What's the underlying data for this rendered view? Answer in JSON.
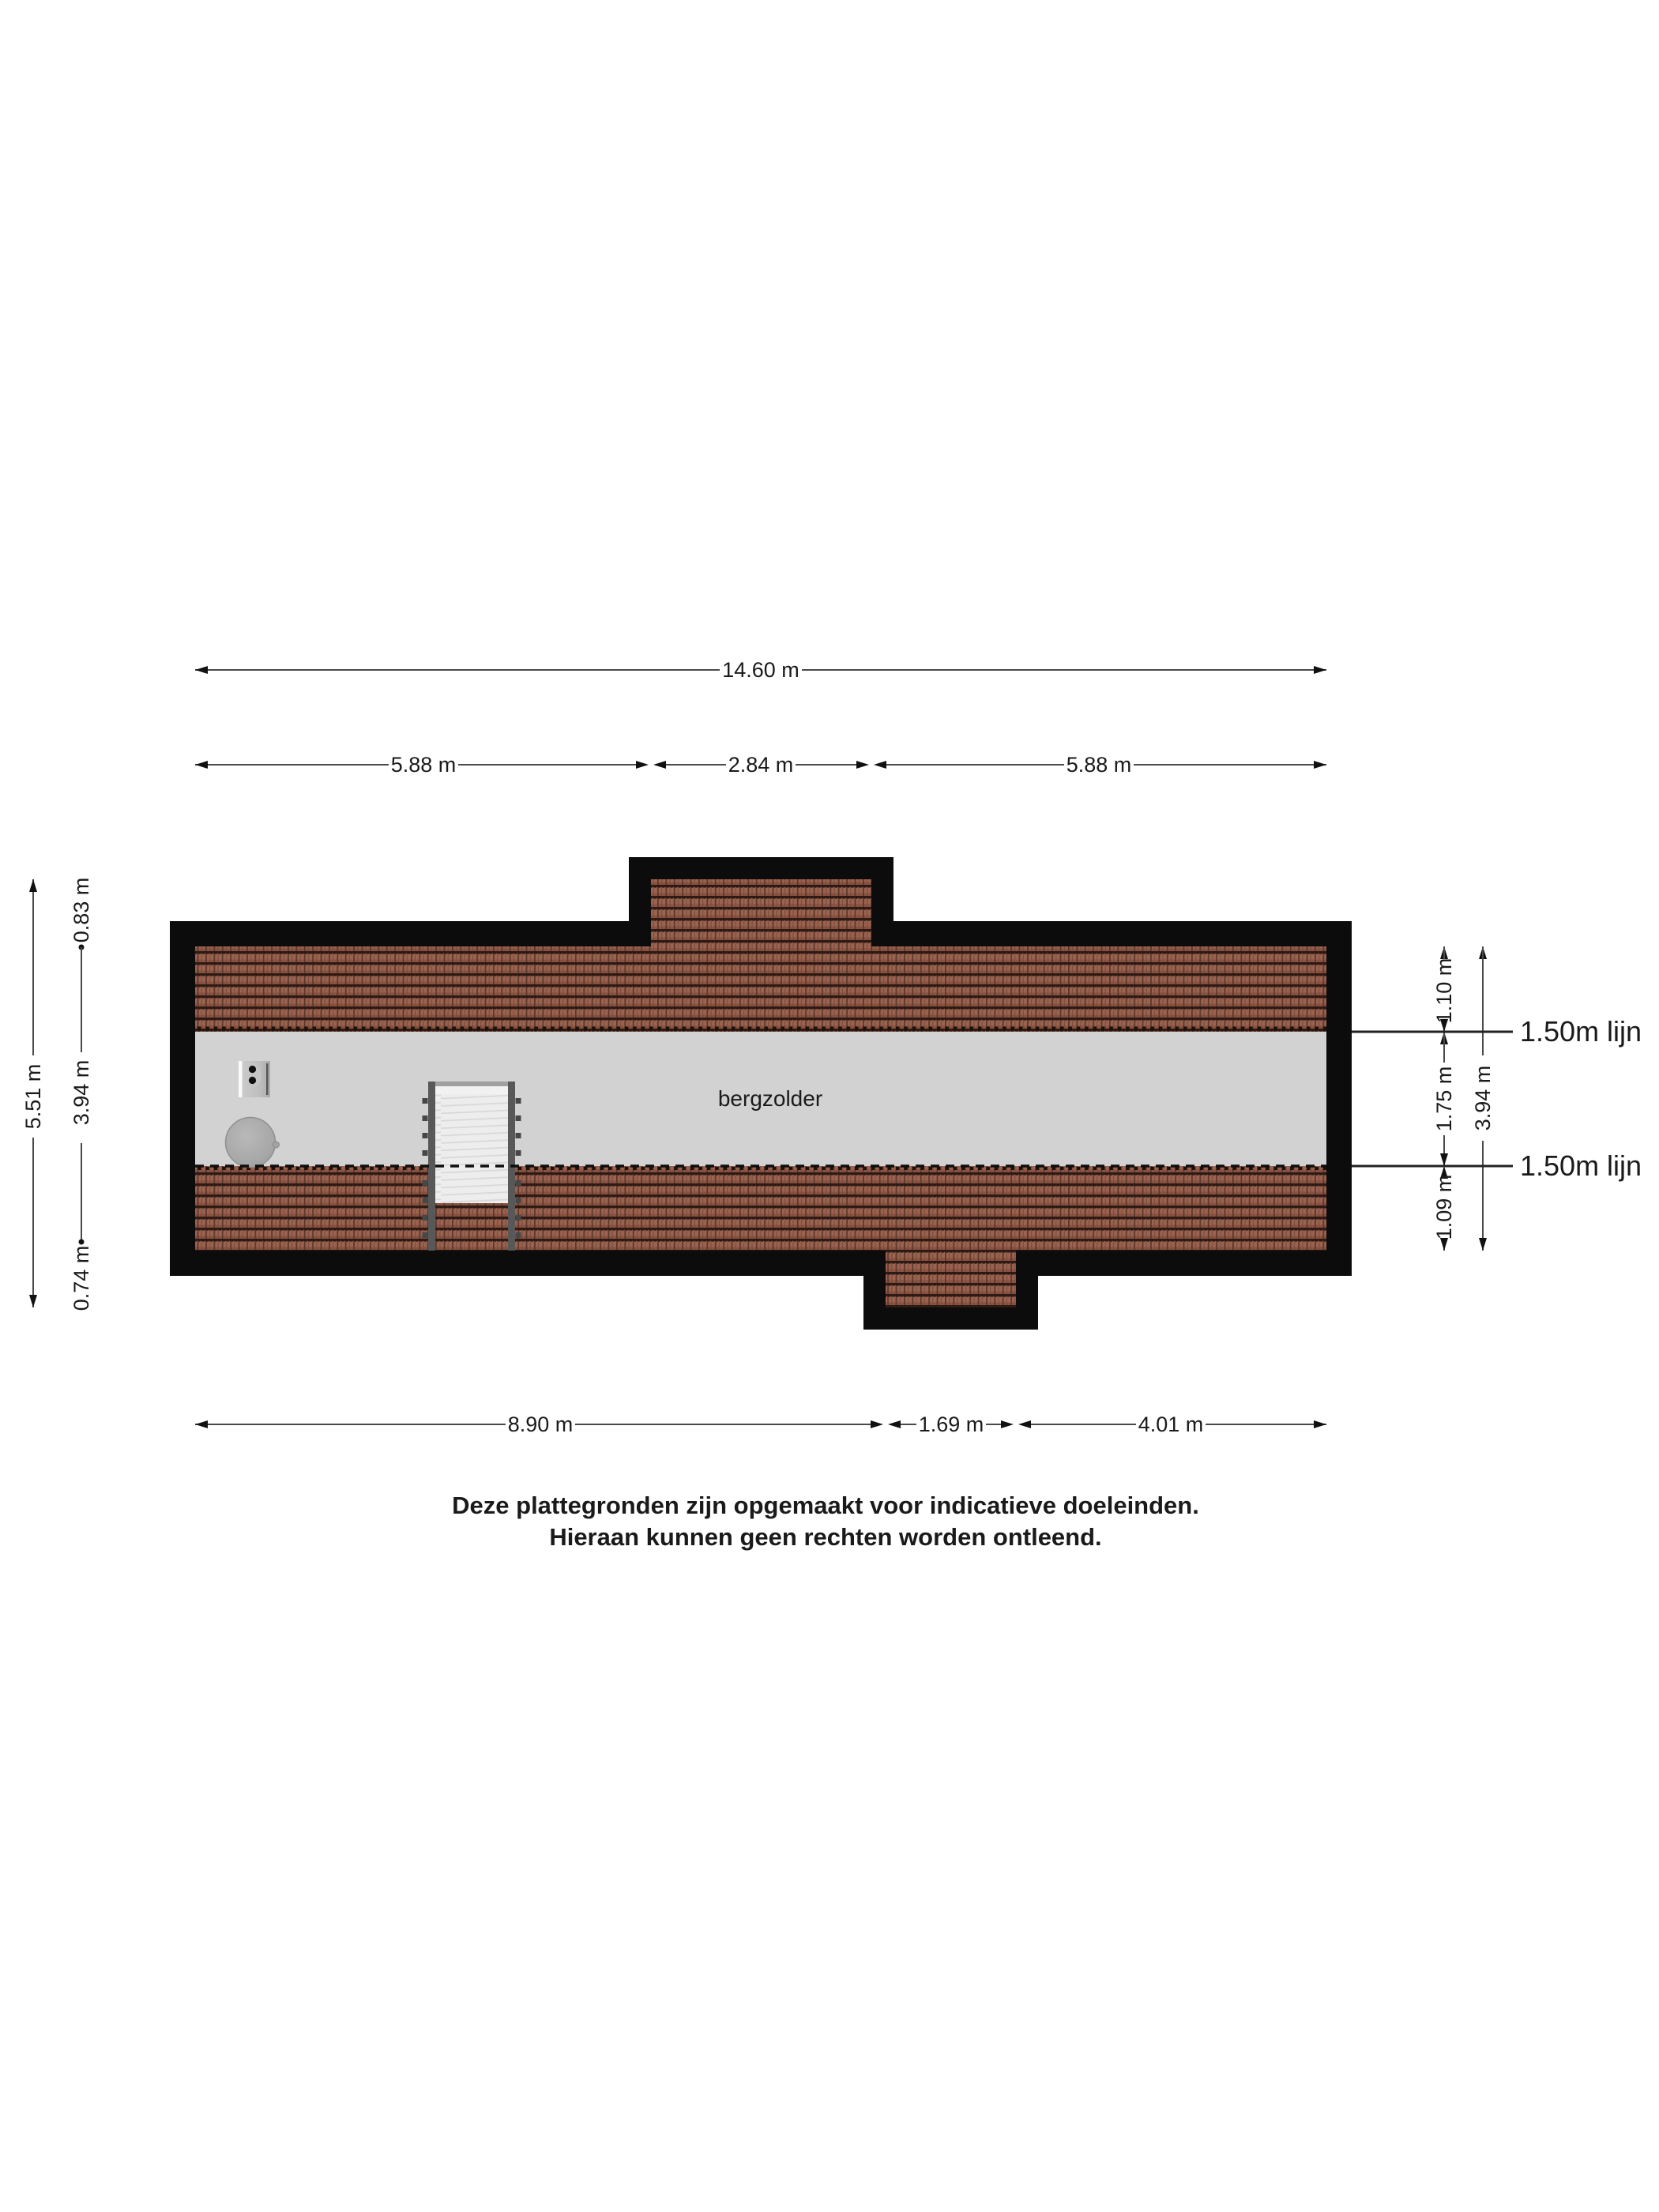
{
  "page": {
    "background": "#ffffff",
    "room_label": "bergzolder",
    "disclaimer": {
      "line1": "Deze plattegronden zijn opgemaakt voor indicatieve doeleinden.",
      "line2": "Hieraan kunnen geen rechten worden ontleend."
    }
  },
  "dimensions": {
    "top_total": "14.60 m",
    "top_segments": [
      "5.88 m",
      "2.84 m",
      "5.88 m"
    ],
    "bottom_segments": [
      "8.90 m",
      "1.69 m",
      "4.01 m"
    ],
    "left_total": "5.51 m",
    "left_segments": [
      "0.83 m",
      "3.94 m",
      "0.74 m"
    ],
    "right_total": "3.94 m",
    "right_segments": [
      "1.10 m",
      "1.75 m",
      "1.09 m"
    ],
    "height_line_labels": [
      "1.50m lijn",
      "1.50m lijn"
    ]
  },
  "colors": {
    "wall": "#0c0c0c",
    "floor": "#d2d2d2",
    "tile_base": "#9a6350",
    "tile_cap": "#2d1a14",
    "tile_groove": "#5e382c",
    "dim_line": "#4a4a4a"
  }
}
